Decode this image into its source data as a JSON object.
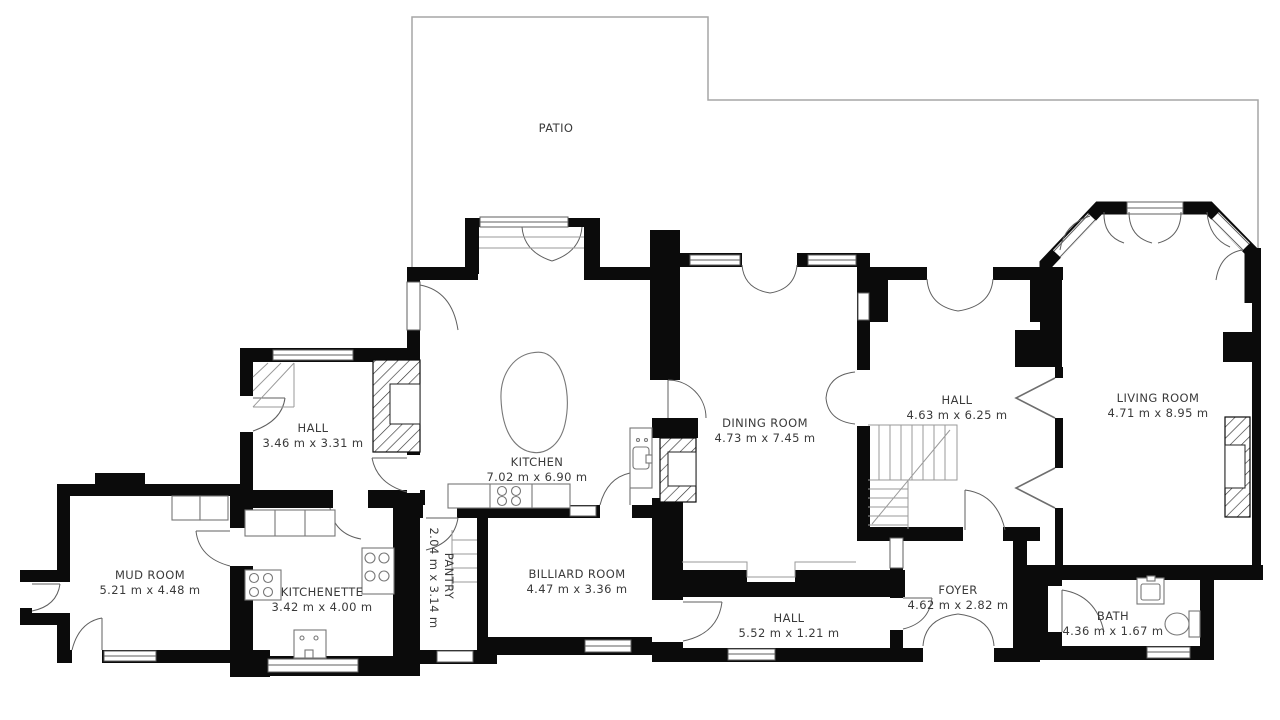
{
  "title": "Floor plan",
  "rooms": [
    {
      "id": "patio",
      "name": "PATIO",
      "dims": ""
    },
    {
      "id": "hall-west",
      "name": "HALL",
      "dims": "3.46 m x 3.31 m"
    },
    {
      "id": "kitchen",
      "name": "KITCHEN",
      "dims": "7.02 m x 6.90 m"
    },
    {
      "id": "dining-room",
      "name": "DINING ROOM",
      "dims": "4.73 m x 7.45 m"
    },
    {
      "id": "hall-center",
      "name": "HALL",
      "dims": "4.63 m x 6.25 m"
    },
    {
      "id": "living-room",
      "name": "LIVING ROOM",
      "dims": "4.71 m x 8.95 m"
    },
    {
      "id": "mud-room",
      "name": "MUD ROOM",
      "dims": "5.21 m x 4.48 m"
    },
    {
      "id": "kitchenette",
      "name": "KITCHENETTE",
      "dims": "3.42 m x 4.00 m"
    },
    {
      "id": "pantry",
      "name": "PANTRY",
      "dims": "2.04 m x 3.14 m"
    },
    {
      "id": "billiard",
      "name": "BILLIARD ROOM",
      "dims": "4.47 m x 3.36 m"
    },
    {
      "id": "hall-bottom",
      "name": "HALL",
      "dims": "5.52 m x 1.21 m"
    },
    {
      "id": "foyer",
      "name": "FOYER",
      "dims": "4.62 m x 2.82 m"
    },
    {
      "id": "bath",
      "name": "BATH",
      "dims": "4.36 m x 1.67 m"
    }
  ],
  "colors": {
    "wall": "#0b0b0b",
    "patio_line": "#a6a6a6",
    "text": "#3a3a3a",
    "frame": "#5f5f5f",
    "thin_line": "#9a9a9a",
    "fixture_line": "#777777"
  }
}
